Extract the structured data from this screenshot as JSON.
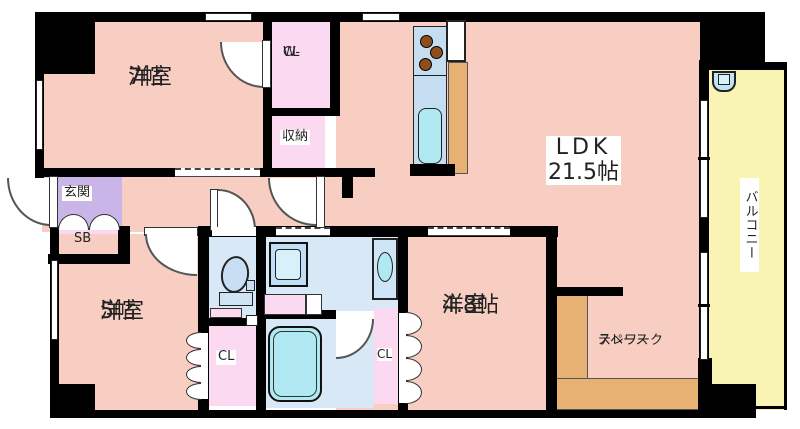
{
  "floorplan": {
    "rooms": {
      "western7": {
        "name": "洋室",
        "size": "7帖"
      },
      "wcl": {
        "line1": "W-",
        "line2": "CL"
      },
      "storage": {
        "label": "収納"
      },
      "ldk": {
        "name": "LDK",
        "size": "21.5帖"
      },
      "genkan": {
        "label": "玄関"
      },
      "shoebox": {
        "label": "SB"
      },
      "western5": {
        "name": "洋室",
        "size": "5帖"
      },
      "closet_west": {
        "label": "CL"
      },
      "closet_east": {
        "label": "CL"
      },
      "western48": {
        "name": "洋室",
        "size": "4.8帖"
      },
      "telework": {
        "line1": "テレワーク",
        "line2": "スペース"
      },
      "balcony": {
        "label": "バルコニー"
      }
    },
    "colors": {
      "wall": "#000000",
      "room-pink": "#f7cec1",
      "closet-pink": "#fbd9f1",
      "entry-purple": "#c9b5e7",
      "water-blue": "#d9e8f6",
      "kitchen-blue": "#c4ddf1",
      "fixture-cyan": "#b0e9f2",
      "counter-tan": "#e6b172",
      "balcony-yellow": "#f9f3b4",
      "burner-brown": "#8e4f1b",
      "label-text": "#222222"
    }
  }
}
